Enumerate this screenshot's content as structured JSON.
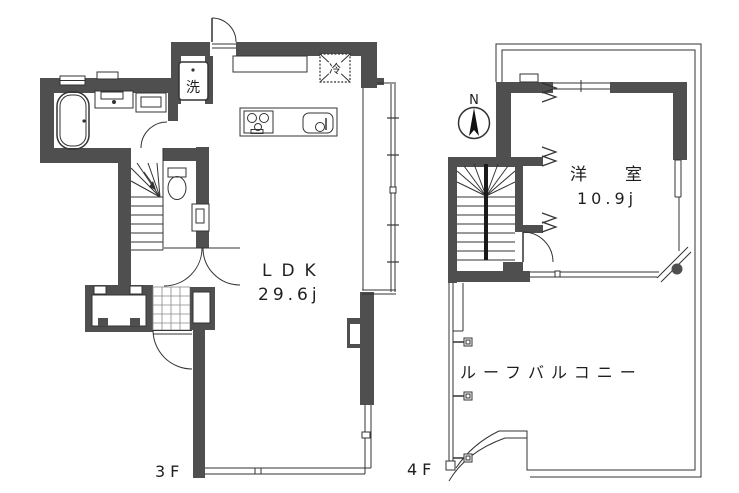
{
  "floor3": {
    "floor_label": "3F",
    "room_label": "LDK",
    "room_area": "29.6j",
    "washer_label": "洗",
    "fridge_label": "冷"
  },
  "floor4": {
    "floor_label": "4F",
    "room_label": "洋室",
    "room_area": "10.9j",
    "balcony_label": "ルーフバルコニー",
    "compass_label": "N"
  },
  "colors": {
    "wall": "#4f4f4f",
    "line": "#333333",
    "background": "#ffffff"
  }
}
